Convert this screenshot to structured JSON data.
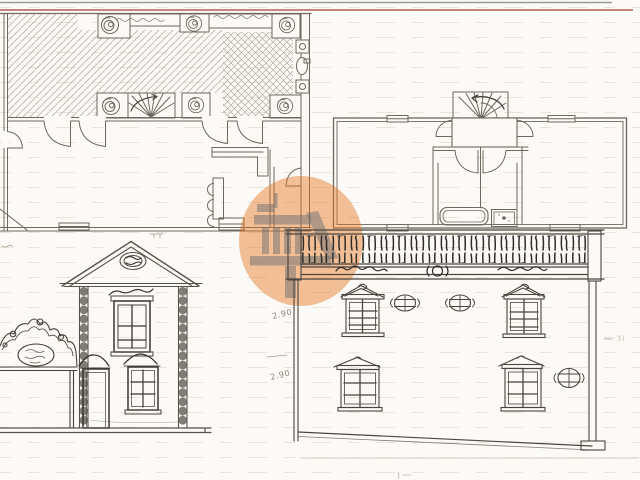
{
  "document": {
    "kind": "hand-drawn architectural sketch, scanned",
    "paper_color": "#fbfaf6",
    "margin_rule_color": "#c4867b",
    "pencil_color": "#6e685d",
    "ink_color": "#3a3733"
  },
  "panels": {
    "plan_top_left": {
      "role": "ground floor plan with hatched terrace, rosettes, fan stair, counter and door swings"
    },
    "plan_top_right": {
      "role": "upper floor plan with spiral stair, hall, bathtub and sink"
    },
    "elevation_left": {
      "role": "two-storey house elevation with pediment, oval medallion, door and windows"
    },
    "elevation_right": {
      "role": "main facade elevation with ornamental balustrade, pedimented windows and oval oculi"
    }
  },
  "watermark": {
    "shape": "circle",
    "icon": "classical-building-icon",
    "circle_color": "#e3711b",
    "icon_color": "#6f6f6f"
  },
  "annotations": {
    "dim1": "2.90",
    "dim2": "2.90",
    "dim3": "3)"
  }
}
